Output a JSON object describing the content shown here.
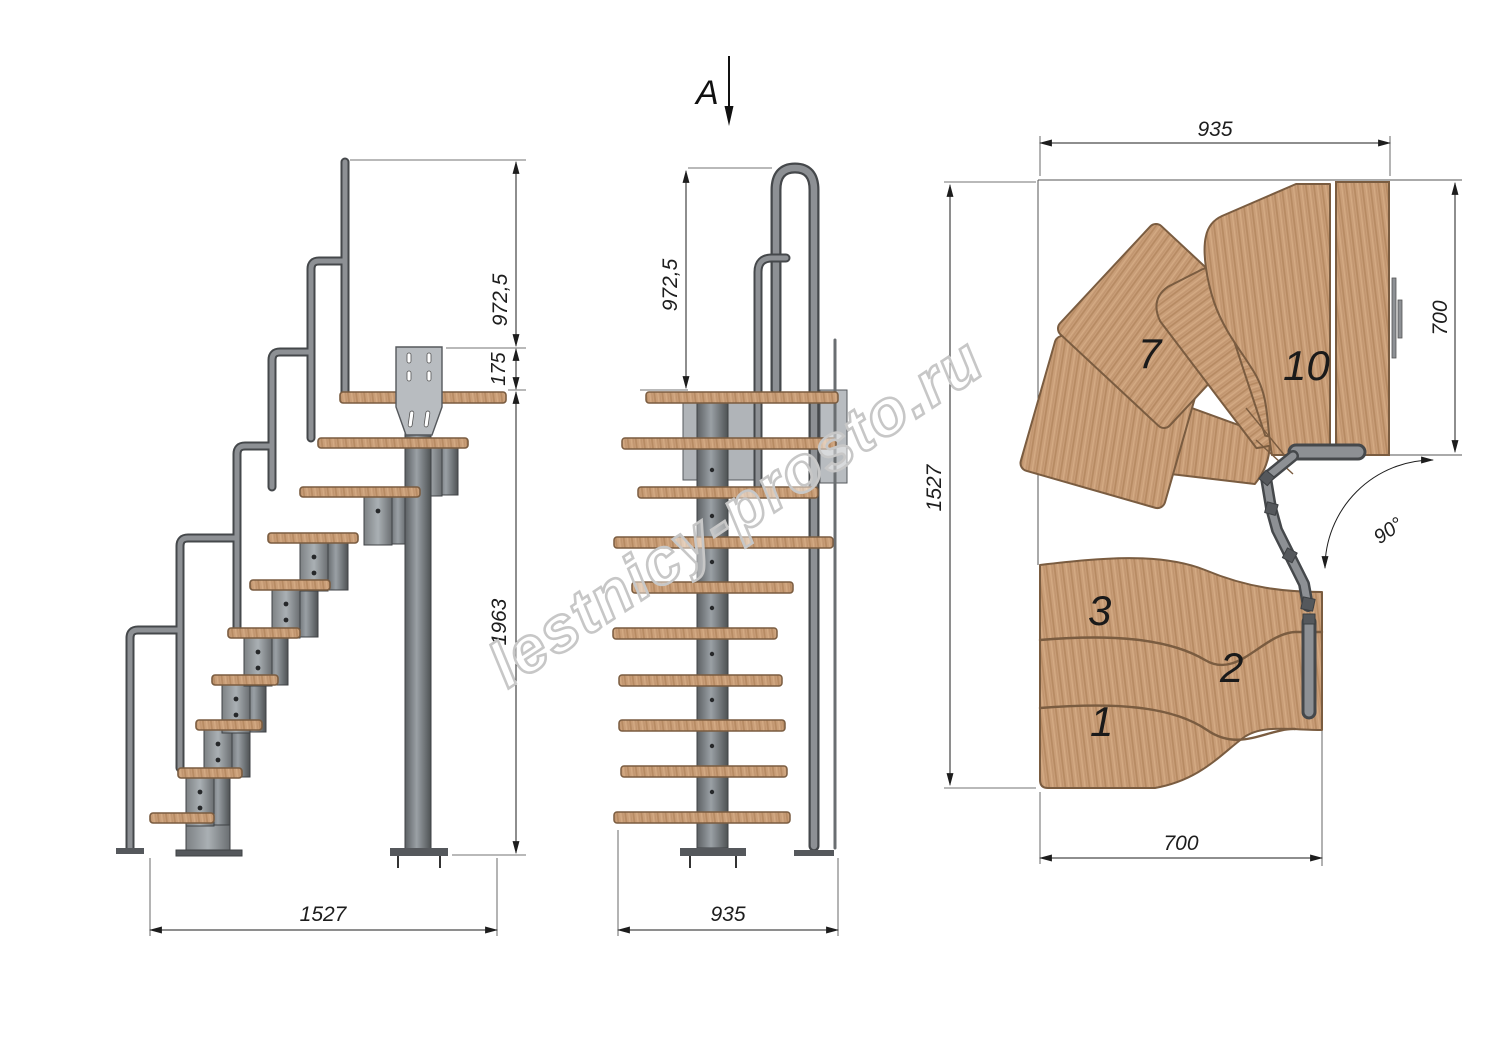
{
  "watermark": {
    "text": "lestnicy-prosto.ru"
  },
  "section_label": {
    "letter": "A"
  },
  "side_view": {
    "title": "side-elevation",
    "dim_rail_height": "972,5",
    "dim_floor_thickness": "175",
    "dim_total_height": "1963",
    "dim_length": "1527"
  },
  "front_view": {
    "title": "front-elevation",
    "dim_rail_height": "972,5",
    "dim_width": "935"
  },
  "plan_view": {
    "title": "plan-view",
    "dim_width_top": "935",
    "dim_landing_depth": "700",
    "dim_height_left": "1527",
    "dim_flight_width": "700",
    "dim_turn_angle": "90°",
    "tread_numbers": {
      "t1": "1",
      "t2": "2",
      "t3": "3",
      "t7": "7",
      "t10": "10"
    }
  },
  "colors": {
    "wood": "#c99e78",
    "wood_grain": "#b68a62",
    "wood_edge": "#7a5c40",
    "metal": "#8d9094",
    "metal_dark": "#55585c",
    "plate": "#b8bcc0",
    "dim_line": "#222222",
    "watermark": "#c7c7c7"
  }
}
